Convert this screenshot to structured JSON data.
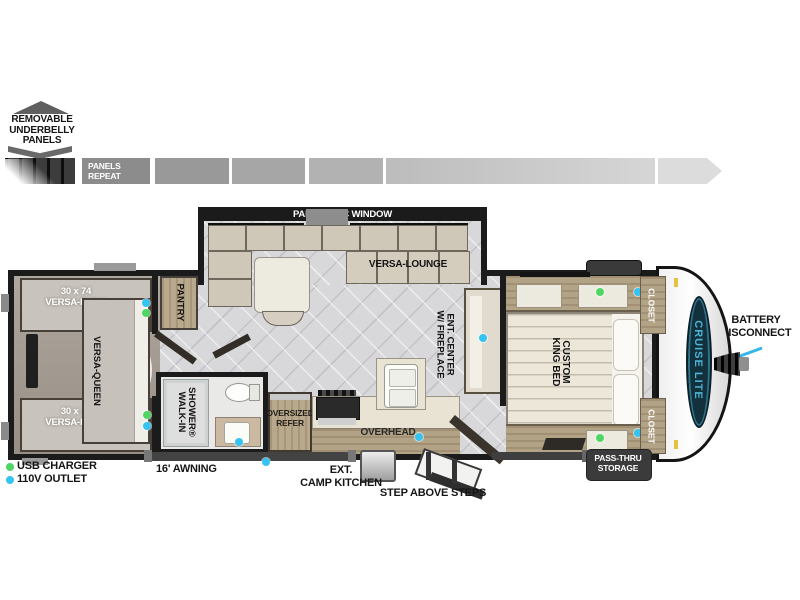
{
  "colors": {
    "usb": "#4fd563",
    "outlet": "#35c3f2",
    "arrow": "#35b5e8",
    "badge_navy": "#13303d",
    "badge_teal": "#4cb5d6"
  },
  "underbelly": {
    "line1": "REMOVABLE",
    "line2": "UNDERBELLY",
    "line3": "PANELS",
    "repeat_line1": "PANELS",
    "repeat_line2": "REPEAT"
  },
  "slideout": {
    "window_label": "PANORAMIC WINDOW",
    "lounge_label": "VERSA-LOUNGE"
  },
  "rooms": {
    "bunk_top": {
      "line1": "30 x 74",
      "line2": "VERSA-BUNK"
    },
    "bunk_bottom": {
      "line1": "30 x 74",
      "line2": "VERSA-BUNK"
    },
    "queen": {
      "label": "VERSA-QUEEN"
    },
    "pantry": {
      "label": "PANTRY"
    },
    "shower": {
      "line1": "WALK-IN",
      "line2": "SHOWER®"
    },
    "refer": {
      "line1": "OVERSIZED",
      "line2": "REFER"
    },
    "overhead": {
      "label": "OVERHEAD"
    },
    "ent_center": {
      "line1": "ENT. CENTER",
      "line2": "W/ FIREPLACE"
    },
    "king_bed": {
      "line1": "CUSTOM",
      "line2": "KING BED"
    },
    "closet_top": {
      "label": "CLOSET"
    },
    "closet_bottom": {
      "label": "CLOSET"
    }
  },
  "exterior": {
    "awning": "16' AWNING",
    "camp_kitchen_line1": "EXT.",
    "camp_kitchen_line2": "CAMP KITCHEN",
    "steps": "STEP ABOVE STEPS",
    "passthru_line1": "PASS-THRU",
    "passthru_line2": "STORAGE",
    "battery_line1": "BATTERY",
    "battery_line2": "DISCONNECT"
  },
  "legend": {
    "usb_label": "USB CHARGER",
    "outlet_label": "110V OUTLET"
  },
  "brand": {
    "logo": "CRUISE LITE"
  }
}
